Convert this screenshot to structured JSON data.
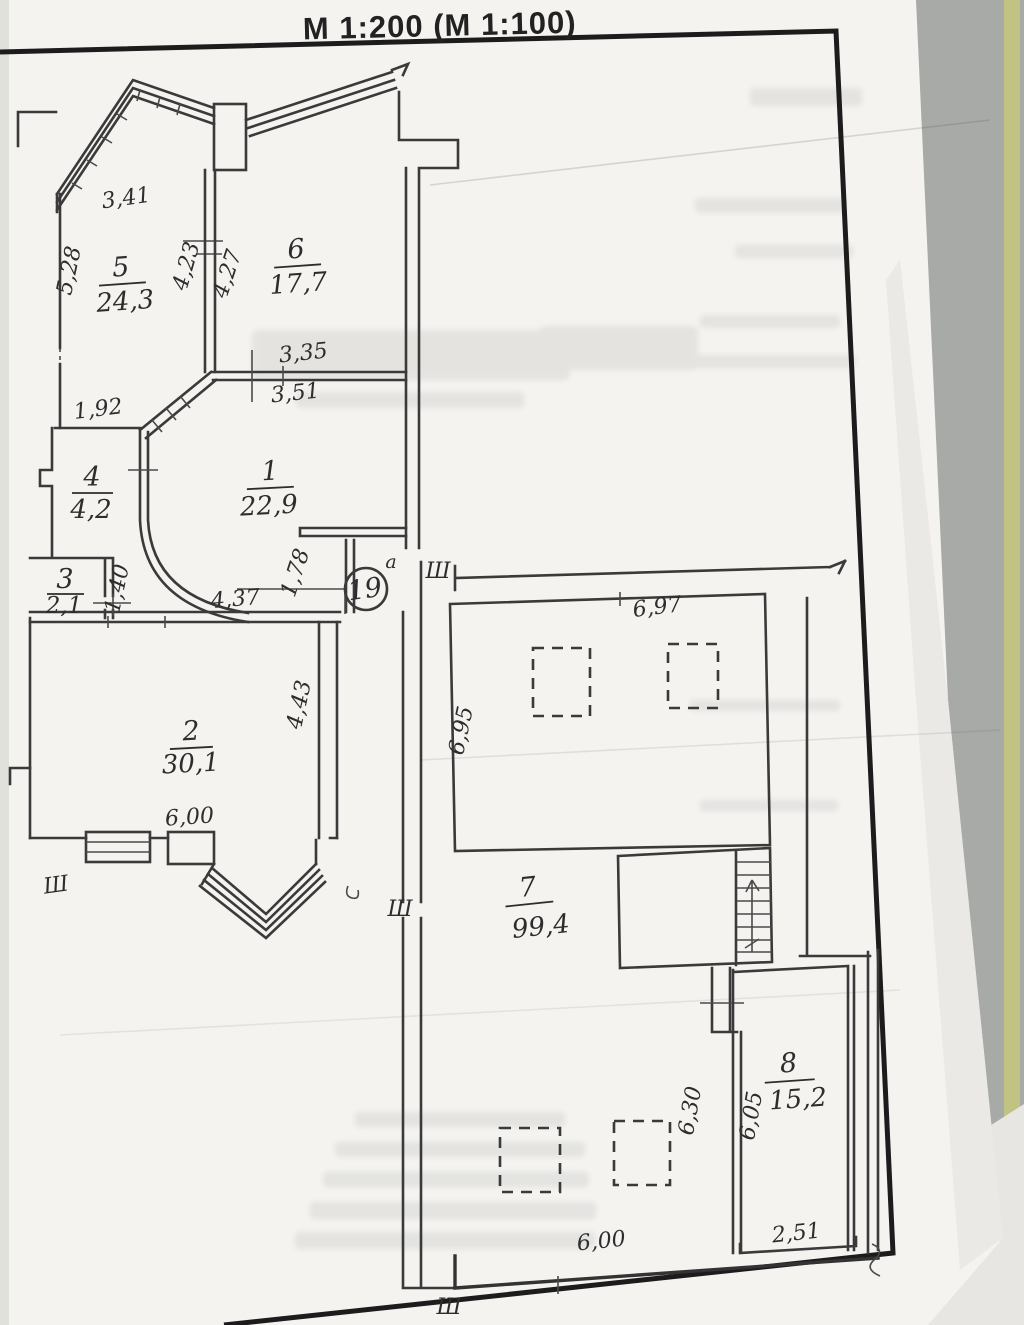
{
  "page": {
    "title": "М 1:200 (М 1:100)"
  },
  "plan": {
    "unit": {
      "number": "19",
      "superscript": "a",
      "door_mark": "Ш"
    },
    "rooms": {
      "r1": {
        "num": "1",
        "area": "22,9"
      },
      "r2": {
        "num": "2",
        "area": "30,1"
      },
      "r3": {
        "num": "3",
        "area": "2,1"
      },
      "r4": {
        "num": "4",
        "area": "4,2"
      },
      "r5": {
        "num": "5",
        "area": "24,3"
      },
      "r6": {
        "num": "6",
        "area": "17,7"
      },
      "r7": {
        "num": "7",
        "area": "99,4"
      },
      "r8": {
        "num": "8",
        "area": "15,2"
      }
    },
    "dims": {
      "d341": "3,41",
      "d528": "5,28",
      "d423": "4,23",
      "d427": "4,27",
      "d335": "3,35",
      "d351": "3,51",
      "d192": "1,92",
      "d140": "1,40",
      "d437": "4,37",
      "d178": "1,78",
      "d443": "4,43",
      "d600": "6,00",
      "d697": "6,97",
      "d695": "6,95",
      "d600b": "6,00",
      "d630": "6,30",
      "d605": "6,05",
      "d251": "2,51"
    }
  }
}
